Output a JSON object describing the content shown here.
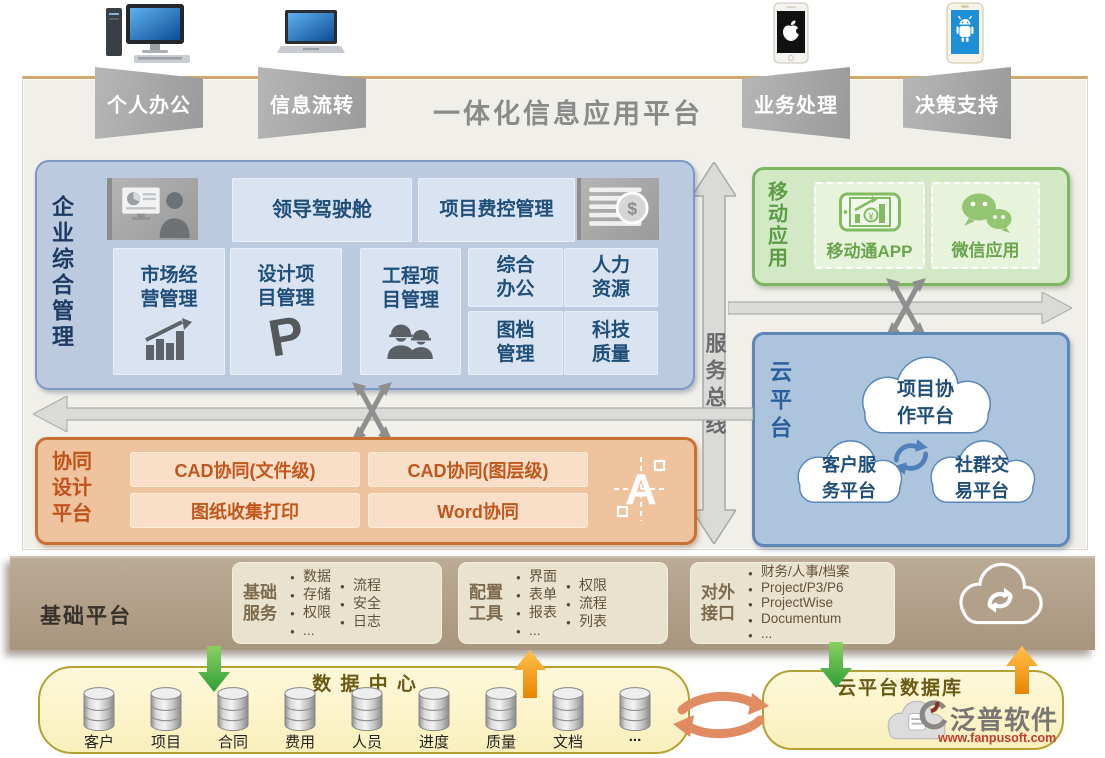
{
  "header": {
    "title": "一体化信息应用平台",
    "banners": [
      "个人办公",
      "信息流转",
      "业务处理",
      "决策支持"
    ],
    "devices": [
      "desktop-computer",
      "laptop",
      "apple-iphone",
      "android-phone"
    ]
  },
  "enterprise": {
    "label": "企业综合管理",
    "dashboard": "领导驾驶舱",
    "dashboard_icon": "executive-dashboard",
    "cost": "项目费控管理",
    "cost_icon": "money-coins",
    "market": {
      "l1": "市场经",
      "l2": "营管理",
      "icon": "bar-chart-growth"
    },
    "design": {
      "l1": "设计项",
      "l2": "目管理",
      "icon": "p-logo"
    },
    "engineering": {
      "l1": "工程项",
      "l2": "目管理",
      "icon": "construction-workers"
    },
    "office": {
      "l1": "综合",
      "l2": "办公"
    },
    "hr": {
      "l1": "人力",
      "l2": "资源"
    },
    "archive": {
      "l1": "图档",
      "l2": "管理"
    },
    "quality": {
      "l1": "科技",
      "l2": "质量"
    }
  },
  "service_bus": {
    "label": "服务总线"
  },
  "mobile": {
    "label": "移动应用",
    "app1": {
      "label": "移动通APP",
      "icon": "mobile-app-phone"
    },
    "app2": {
      "label": "微信应用",
      "icon": "wechat"
    }
  },
  "cloud": {
    "label": "云平台",
    "sync_icon": "sync-arrows",
    "cloud1": {
      "l1": "项目协",
      "l2": "作平台"
    },
    "cloud2": {
      "l1": "客户服",
      "l2": "务平台"
    },
    "cloud3": {
      "l1": "社群交",
      "l2": "易平台"
    }
  },
  "design_platform": {
    "label": "协同设计平台",
    "cell1": "CAD协同(文件级)",
    "cell2": "CAD协同(图层级)",
    "cell3": "图纸收集打印",
    "cell4": "Word协同",
    "icon": "autocad-a"
  },
  "foundation": {
    "label": "基础平台",
    "services": {
      "title": "基础服务",
      "col1": [
        "数据",
        "存储",
        "权限",
        "..."
      ],
      "col2": [
        "流程",
        "安全",
        "日志"
      ]
    },
    "tools": {
      "title": "配置工具",
      "col1": [
        "界面",
        "表单",
        "报表",
        "..."
      ],
      "col2": [
        "权限",
        "流程",
        "列表"
      ]
    },
    "interfaces": {
      "title": "对外接口",
      "items": [
        "财务/人事/档案",
        "Project/P3/P6",
        "ProjectWise",
        "Documentum",
        "..."
      ]
    },
    "cloud_icon": "cloud-sync"
  },
  "data_center": {
    "title": "数 据 中 心",
    "databases": [
      "客户",
      "项目",
      "合同",
      "费用",
      "人员",
      "进度",
      "质量",
      "文档",
      "..."
    ]
  },
  "cloud_db": {
    "title": "云平台数据库",
    "icon": "cloud-database"
  },
  "watermark": {
    "brand": "泛普软件",
    "url": "www.fanpusoft.com"
  },
  "colors": {
    "panel_bg": "#f1efea",
    "band_bg": "#b3a08a",
    "blue_box_bg": "#bccadf",
    "blue_cell_bg": "#d9e3f2",
    "blue_text": "#1f4e79",
    "green_box_bg": "#d3e8c5",
    "green_text": "#5d9c46",
    "cloud_box_bg": "#adc5dc",
    "orange_box_bg": "#eec39e",
    "orange_text": "#c0531a",
    "yellow_box_bg": "#fdf6d2",
    "olive_title": "#6a5a16",
    "banner_gray": "#a8a8a8",
    "green_arrow": "#4aa43c",
    "orange_arrow": "#f0930a",
    "salmon_arrow": "#e18b63",
    "arrow_gray": "#dadad8"
  }
}
